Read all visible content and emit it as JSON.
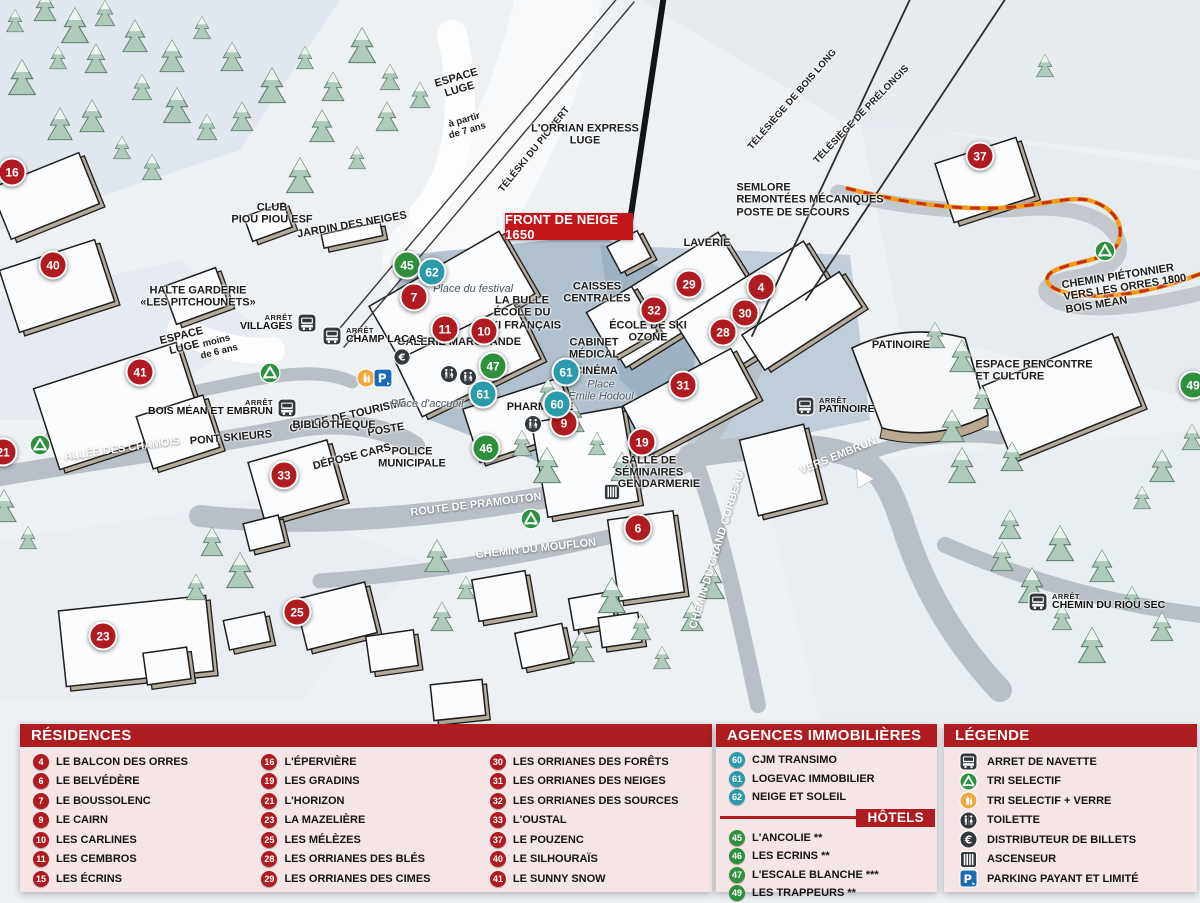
{
  "colors": {
    "header_red": "#ae1b20",
    "panel_pink": "#f5e5e5",
    "marker_red": "#b01b21",
    "marker_teal": "#2b9aab",
    "marker_green": "#2e8f3d",
    "path_orange": "#f49d18",
    "path_dash_red": "#c22f12"
  },
  "map": {
    "title_badge": "FRONT DE NEIGE 1650",
    "bus_stop_small": "ARRÊT",
    "labels": [
      {
        "lines": [
          "ESPACE",
          "LUGE"
        ],
        "x": 458,
        "y": 84,
        "rot": -16
      },
      {
        "lines": [
          "à partir",
          "de 7 ans"
        ],
        "x": 466,
        "y": 126,
        "rot": -16,
        "cls": "plain"
      },
      {
        "lines": [
          "TÉLÉSKI DU PIC VERT"
        ],
        "x": 535,
        "y": 150,
        "rot": -51,
        "cls": "small"
      },
      {
        "lines": [
          "L'ORRIAN EXPRESS",
          "LUGE"
        ],
        "x": 585,
        "y": 135
      },
      {
        "lines": [
          "TÉLÉSIÈGE DE BOIS LONG"
        ],
        "x": 793,
        "y": 100,
        "rot": -49,
        "cls": "small"
      },
      {
        "lines": [
          "TÉLÉSIÈGE DE PRÉLONGIS"
        ],
        "x": 862,
        "y": 115,
        "rot": -46,
        "cls": "small"
      },
      {
        "lines": [
          "SEMLORE",
          "REMONTÉES MÉCANIQUES",
          "POSTE DE SECOURS"
        ],
        "x": 810,
        "y": 200,
        "cls": "left"
      },
      {
        "lines": [
          "CHEMIN PIÉTONNIER",
          "VERS LES ORRES 1800",
          "BOIS MÉAN"
        ],
        "x": 1125,
        "y": 288,
        "rot": -9,
        "cls": "left"
      },
      {
        "lines": [
          "CLUB",
          "PIOU PIOU ESF"
        ],
        "x": 272,
        "y": 214
      },
      {
        "lines": [
          "JARDIN DES NEIGES"
        ],
        "x": 352,
        "y": 225,
        "rot": -10
      },
      {
        "lines": [
          "HALTE GARDERIE",
          "«LES PITCHOUNETS»"
        ],
        "x": 198,
        "y": 297
      },
      {
        "lines": [
          "ESPACE",
          "LUGE"
        ],
        "x": 183,
        "y": 342,
        "rot": -14
      },
      {
        "lines": [
          "moins",
          "de 6 ans"
        ],
        "x": 218,
        "y": 347,
        "rot": -14,
        "cls": "plain"
      },
      {
        "lines": [
          "GALERIE MARCHANDE"
        ],
        "x": 459,
        "y": 342
      },
      {
        "lines": [
          "Place du festival"
        ],
        "x": 473,
        "y": 289,
        "cls": "italic"
      },
      {
        "lines": [
          "LA BULLE",
          "ÉCOLE DU",
          "SKI FRANÇAIS"
        ],
        "x": 522,
        "y": 313
      },
      {
        "lines": [
          "CAISSES",
          "CENTRALES"
        ],
        "x": 597,
        "y": 293
      },
      {
        "lines": [
          "LAVERIE"
        ],
        "x": 707,
        "y": 243
      },
      {
        "lines": [
          "ÉCOLE DE SKI",
          "OZONE"
        ],
        "x": 648,
        "y": 332
      },
      {
        "lines": [
          "CABINET",
          "MÉDICAL"
        ],
        "x": 594,
        "y": 349
      },
      {
        "lines": [
          "CINÉMA"
        ],
        "x": 596,
        "y": 371
      },
      {
        "lines": [
          "Place",
          "Émile Hodoul"
        ],
        "x": 601,
        "y": 391,
        "cls": "italic"
      },
      {
        "lines": [
          "PHARMACIE"
        ],
        "x": 540,
        "y": 407
      },
      {
        "lines": [
          "OFFICE DE TOURISME"
        ],
        "x": 348,
        "y": 416,
        "rot": -13
      },
      {
        "lines": [
          "POSTE"
        ],
        "x": 386,
        "y": 430,
        "rot": -10
      },
      {
        "lines": [
          "BIBLIOTHÈQUE"
        ],
        "x": 334,
        "y": 425
      },
      {
        "lines": [
          "POLICE",
          "MUNICIPALE"
        ],
        "x": 412,
        "y": 458
      },
      {
        "lines": [
          "DÉPOSE CARS"
        ],
        "x": 352,
        "y": 457,
        "rot": -14
      },
      {
        "lines": [
          "PONT SKIEURS"
        ],
        "x": 231,
        "y": 438,
        "rot": -5
      },
      {
        "lines": [
          "ALLÉE DES CHAMOIS"
        ],
        "x": 122,
        "y": 449,
        "rot": -8,
        "cls": "white"
      },
      {
        "lines": [
          "ROUTE DE PRAMOUTON"
        ],
        "x": 476,
        "y": 505,
        "rot": -7,
        "cls": "white"
      },
      {
        "lines": [
          "CHEMIN DU MOUFLON"
        ],
        "x": 536,
        "y": 549,
        "rot": -6,
        "cls": "white"
      },
      {
        "lines": [
          "SALLE DE",
          "SÉMINAIRES"
        ],
        "x": 649,
        "y": 467
      },
      {
        "lines": [
          "GENDARMERIE"
        ],
        "x": 659,
        "y": 484
      },
      {
        "lines": [
          "CHEMIN DU GRAND CORBEAU"
        ],
        "x": 717,
        "y": 550,
        "rot": -73,
        "cls": "white"
      },
      {
        "lines": [
          "VERS EMBRUN"
        ],
        "x": 838,
        "y": 456,
        "rot": -22,
        "cls": "white"
      },
      {
        "lines": [
          "PATINOIRE"
        ],
        "x": 901,
        "y": 345
      },
      {
        "lines": [
          "ESPACE RENCONTRE",
          "ET CULTURE"
        ],
        "x": 1034,
        "y": 371,
        "cls": "left"
      },
      {
        "lines": [
          "Place d'accueil"
        ],
        "x": 427,
        "y": 404,
        "cls": "italic"
      }
    ],
    "bus_stops": [
      {
        "name": "VILLAGES",
        "x": 240,
        "y": 313,
        "side": "right"
      },
      {
        "name": "CHAMP LACAS",
        "x": 322,
        "y": 326,
        "side": "left"
      },
      {
        "name": "BOIS MÉAN ET EMBRUN",
        "x": 148,
        "y": 398,
        "side": "right"
      },
      {
        "name": "PATINOIRE",
        "x": 795,
        "y": 396,
        "side": "left"
      },
      {
        "name": "CHEMIN DU RIOU SEC",
        "x": 1028,
        "y": 592,
        "side": "left"
      }
    ],
    "icons": [
      {
        "name": "recycle-icon",
        "x": 270,
        "y": 373,
        "s": 22
      },
      {
        "name": "recycle-icon",
        "x": 40,
        "y": 445,
        "s": 22
      },
      {
        "name": "recycle-icon",
        "x": 531,
        "y": 519,
        "s": 22
      },
      {
        "name": "recycle-icon",
        "x": 1105,
        "y": 251,
        "s": 22
      },
      {
        "name": "recycle-glass-icon",
        "x": 366,
        "y": 378,
        "s": 20
      },
      {
        "name": "parking-icon",
        "x": 383,
        "y": 378,
        "s": 20
      },
      {
        "name": "euro-icon",
        "x": 402,
        "y": 357,
        "s": 18
      },
      {
        "name": "toilet-icon",
        "x": 449,
        "y": 374,
        "s": 19
      },
      {
        "name": "toilet-icon",
        "x": 468,
        "y": 377,
        "s": 19
      },
      {
        "name": "toilet-icon",
        "x": 533,
        "y": 424,
        "s": 19
      },
      {
        "name": "elevator-icon",
        "x": 612,
        "y": 492,
        "s": 18
      }
    ],
    "markers": [
      {
        "n": "16",
        "c": "r",
        "x": 12,
        "y": 172
      },
      {
        "n": "40",
        "c": "r",
        "x": 53,
        "y": 265
      },
      {
        "n": "41",
        "c": "r",
        "x": 140,
        "y": 372
      },
      {
        "n": "21",
        "c": "r",
        "x": 3,
        "y": 452
      },
      {
        "n": "23",
        "c": "r",
        "x": 103,
        "y": 636
      },
      {
        "n": "33",
        "c": "r",
        "x": 284,
        "y": 475
      },
      {
        "n": "25",
        "c": "r",
        "x": 297,
        "y": 612
      },
      {
        "n": "45",
        "c": "g",
        "x": 407,
        "y": 265
      },
      {
        "n": "62",
        "c": "t",
        "x": 432,
        "y": 272
      },
      {
        "n": "7",
        "c": "r",
        "x": 414,
        "y": 297
      },
      {
        "n": "11",
        "c": "r",
        "x": 445,
        "y": 329
      },
      {
        "n": "10",
        "c": "r",
        "x": 484,
        "y": 331
      },
      {
        "n": "47",
        "c": "g",
        "x": 493,
        "y": 366
      },
      {
        "n": "61",
        "c": "t",
        "x": 483,
        "y": 394
      },
      {
        "n": "61",
        "c": "t",
        "x": 566,
        "y": 372
      },
      {
        "n": "46",
        "c": "g",
        "x": 486,
        "y": 448
      },
      {
        "n": "9",
        "c": "r",
        "x": 564,
        "y": 423
      },
      {
        "n": "60",
        "c": "t",
        "x": 557,
        "y": 404
      },
      {
        "n": "19",
        "c": "r",
        "x": 642,
        "y": 442
      },
      {
        "n": "6",
        "c": "r",
        "x": 638,
        "y": 528
      },
      {
        "n": "29",
        "c": "r",
        "x": 689,
        "y": 284
      },
      {
        "n": "32",
        "c": "r",
        "x": 654,
        "y": 310
      },
      {
        "n": "4",
        "c": "r",
        "x": 761,
        "y": 287
      },
      {
        "n": "30",
        "c": "r",
        "x": 745,
        "y": 313
      },
      {
        "n": "28",
        "c": "r",
        "x": 723,
        "y": 332
      },
      {
        "n": "31",
        "c": "r",
        "x": 683,
        "y": 385
      },
      {
        "n": "37",
        "c": "r",
        "x": 980,
        "y": 156
      },
      {
        "n": "49",
        "c": "g",
        "x": 1193,
        "y": 385
      }
    ]
  },
  "legend_panel": {
    "residences": {
      "title": "RÉSIDENCES",
      "columns": [
        [
          {
            "n": "4",
            "label": "LE BALCON DES ORRES"
          },
          {
            "n": "6",
            "label": "LE BELVÉDÈRE"
          },
          {
            "n": "7",
            "label": "LE BOUSSOLENC"
          },
          {
            "n": "9",
            "label": "LE CAIRN"
          },
          {
            "n": "10",
            "label": "LES CARLINES"
          },
          {
            "n": "11",
            "label": "LES CEMBROS"
          },
          {
            "n": "15",
            "label": "LES ÉCRINS"
          }
        ],
        [
          {
            "n": "16",
            "label": "L'ÉPERVIÈRE"
          },
          {
            "n": "19",
            "label": "LES GRADINS"
          },
          {
            "n": "21",
            "label": "L'HORIZON"
          },
          {
            "n": "23",
            "label": "LA MAZELIÈRE"
          },
          {
            "n": "25",
            "label": "LES MÉLÈZES"
          },
          {
            "n": "28",
            "label": "LES ORRIANES DES BLÉS"
          },
          {
            "n": "29",
            "label": "LES ORRIANES DES CIMES"
          }
        ],
        [
          {
            "n": "30",
            "label": "LES ORRIANES DES FORÊTS"
          },
          {
            "n": "31",
            "label": "LES ORRIANES DES NEIGES"
          },
          {
            "n": "32",
            "label": "LES ORRIANES DES SOURCES"
          },
          {
            "n": "33",
            "label": "L'OUSTAL"
          },
          {
            "n": "37",
            "label": "LE POUZENC"
          },
          {
            "n": "40",
            "label": "LE SILHOURAÏS"
          },
          {
            "n": "41",
            "label": "LE SUNNY SNOW"
          }
        ]
      ]
    },
    "agences": {
      "title": "AGENCES IMMOBILIÈRES",
      "items": [
        {
          "n": "60",
          "label": "CJM TRANSIMO"
        },
        {
          "n": "61",
          "label": "LOGEVAC IMMOBILIER"
        },
        {
          "n": "62",
          "label": "NEIGE ET SOLEIL"
        }
      ]
    },
    "hotels": {
      "title": "HÔTELS",
      "items": [
        {
          "n": "45",
          "label": "L'ANCOLIE **"
        },
        {
          "n": "46",
          "label": "LES ECRINS **"
        },
        {
          "n": "47",
          "label": "L'ESCALE BLANCHE ***"
        },
        {
          "n": "49",
          "label": "LES TRAPPEURS **"
        }
      ]
    },
    "legende": {
      "title": "LÉGENDE",
      "items": [
        {
          "icon": "bus-icon",
          "label": "ARRET DE NAVETTE"
        },
        {
          "icon": "recycle-icon",
          "label": "TRI SELECTIF"
        },
        {
          "icon": "recycle-glass-icon",
          "label": "TRI SELECTIF + VERRE"
        },
        {
          "icon": "toilet-icon",
          "label": "TOILETTE"
        },
        {
          "icon": "euro-icon",
          "label": "DISTRIBUTEUR DE BILLETS"
        },
        {
          "icon": "elevator-icon",
          "label": "ASCENSEUR"
        },
        {
          "icon": "parking-icon",
          "label": "PARKING PAYANT ET LIMITÉ"
        }
      ]
    }
  }
}
